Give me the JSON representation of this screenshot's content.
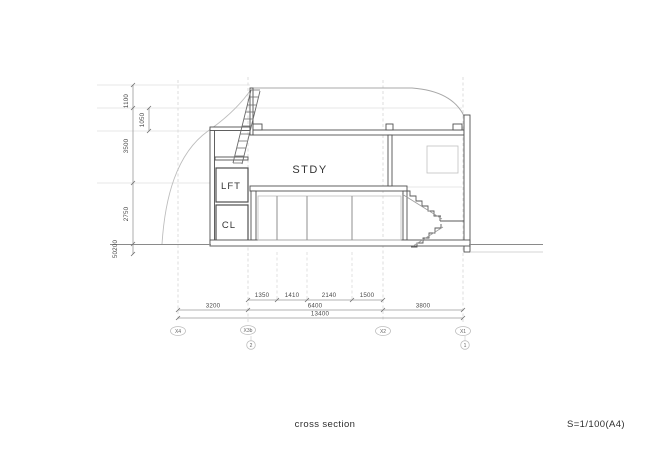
{
  "titleblock": {
    "title": "cross section",
    "scale": "S=1/100(A4)"
  },
  "rooms": {
    "stdy": "STDY",
    "lft": "LFT",
    "cl": "CL"
  },
  "dims": {
    "left": {
      "d1": "1100",
      "d2": "1050",
      "d3": "3500",
      "d4": "2750",
      "d5": "50200"
    },
    "row1": {
      "d1": "1350",
      "d2": "1410",
      "d3": "2140",
      "d4": "1500"
    },
    "row2": {
      "d1": "3200",
      "d2": "6400",
      "d3": "3800"
    },
    "row3": {
      "d1": "13400"
    }
  },
  "grid": {
    "x4": "X4",
    "x3b": "X3b",
    "x2": "X2",
    "x1": "X1",
    "c2": "2",
    "c1": "1"
  },
  "colors": {
    "cut_line": "#4f4f4f",
    "light_line": "#b5b5b5",
    "grid_line": "#cccccc",
    "text": "#3d3d3d"
  }
}
